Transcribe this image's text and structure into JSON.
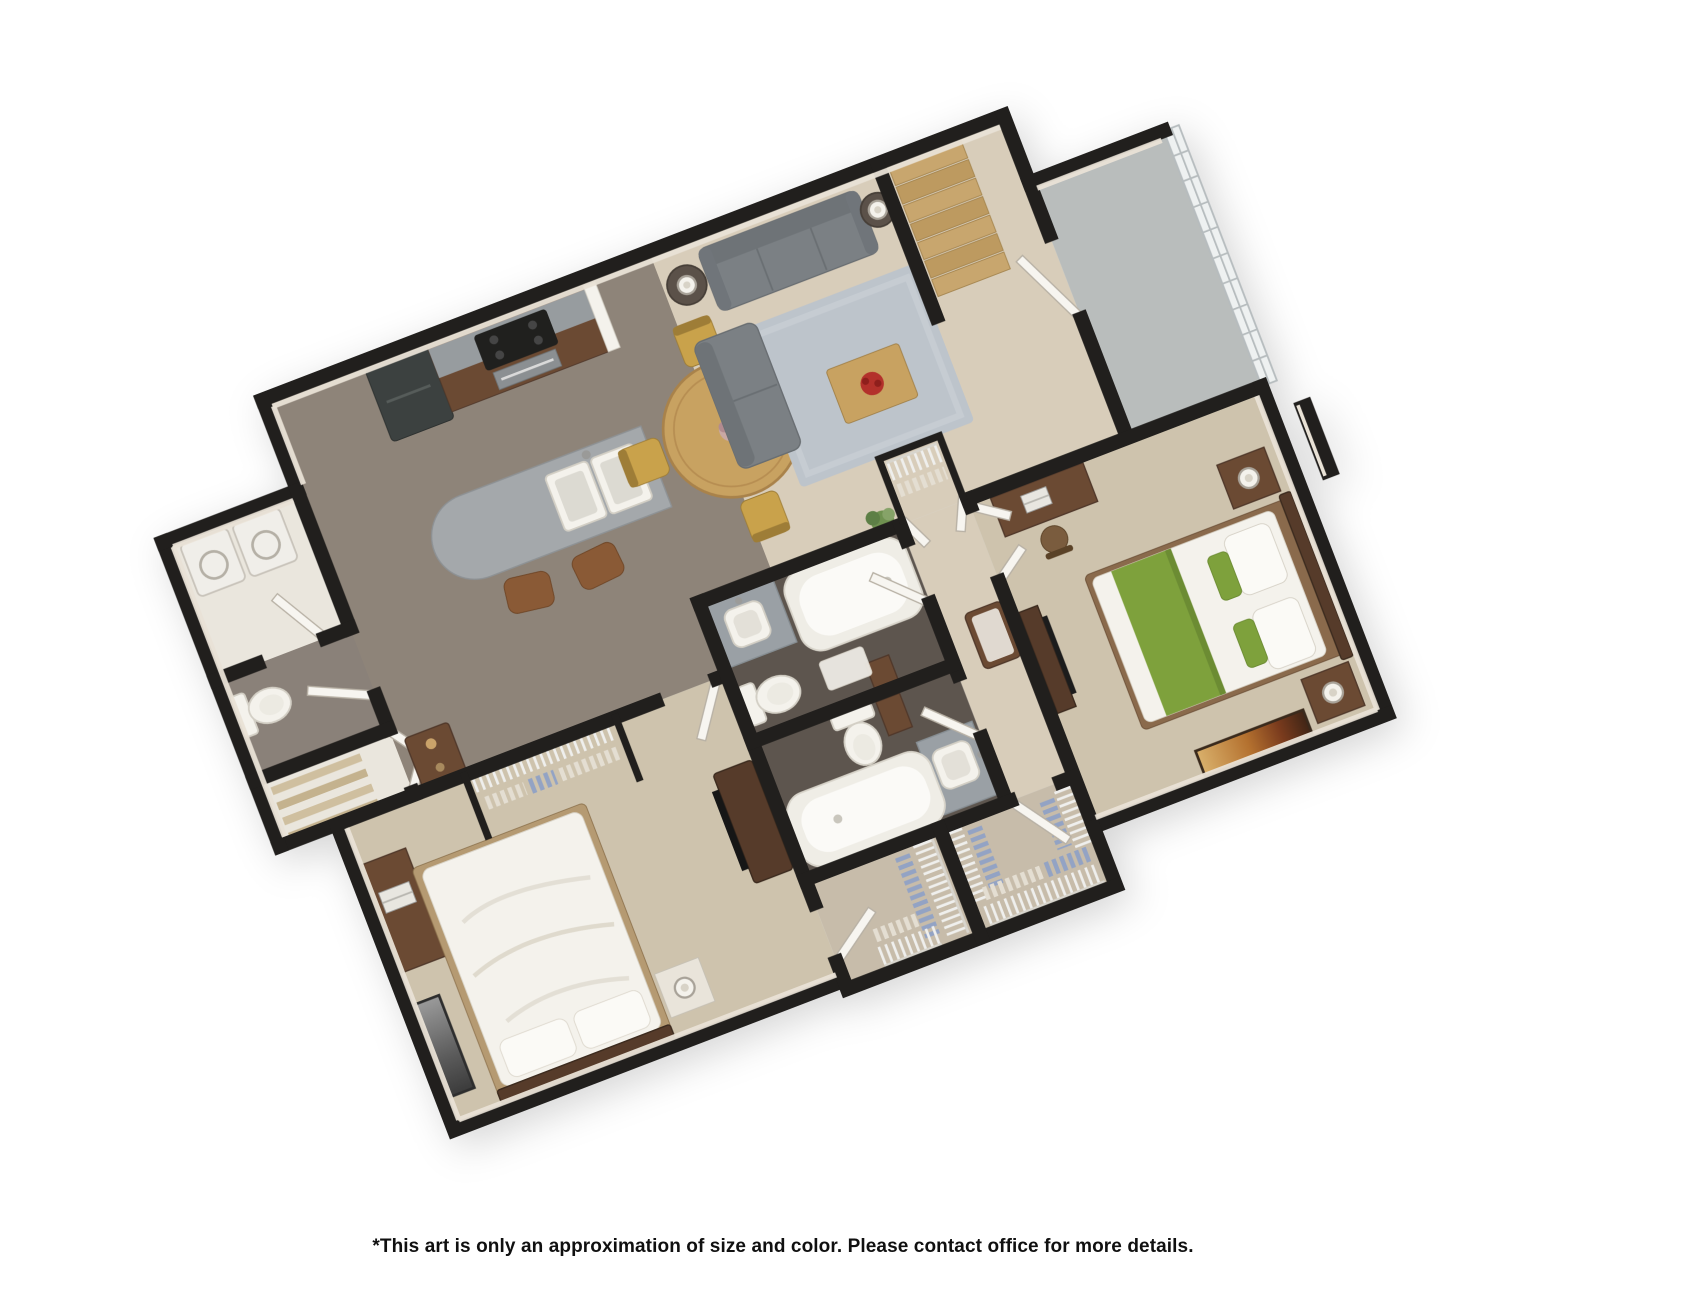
{
  "window": {
    "width": 1704,
    "height": 1294,
    "background": "#ffffff"
  },
  "disclaimer": "*This art is only an approximation of size and color. Please contact office for more details.",
  "floorplan": {
    "type": "3d-rendered-floor-plan",
    "view": "rotated top-down 3D dollhouse render",
    "rotation_deg": -21,
    "layout": "2 bedroom / 2 bathroom apartment with open kitchen-dining-living area, entry stair hall, patio, two walk-in closets, laundry and powder room",
    "colors": {
      "wall": "#211f1d",
      "wall_face": "#e9e2d6",
      "carpet_taupe": "#8e8479",
      "carpet_beige": "#d8cdba",
      "carpet_bedroom": "#cec3ad",
      "tile_bath": "#5d554e",
      "tile_powder": "#8a8179",
      "concrete": "#b9bdbc",
      "closet_floor": "#c7bcaa",
      "floor_white": "#eae6dd",
      "wood_brown": "#6b4a33",
      "wood_dark": "#563b2a",
      "granite": "#9aa0a5",
      "island_granite": "#a4a8ab",
      "appliance_dark": "#3c4140",
      "sofa_gray": "#7b8084",
      "rug_gray": "#bdc4cb",
      "table_wood": "#c8a261",
      "chair_gold": "#c9a24b",
      "steps_wood": "#c5a26b",
      "bed_green": "#7ea13c",
      "linen_white": "#f4f2ec",
      "door_white": "#f7f5f0",
      "shelf_wire": "#efefed",
      "clothes_blue": "#93a3c4",
      "clothes_cream": "#e4ded2",
      "glass": "#eef1f1",
      "glass_mullion": "#b6bcbe",
      "accent_red": "#b3312b",
      "plant_green": "#6f9150",
      "art_gold": "#c08a3e"
    },
    "rooms": [
      {
        "name": "living-room",
        "features": [
          "sofa",
          "loveseat",
          "area-rug",
          "coffee-table",
          "red-floral-centerpiece",
          "end-table",
          "end-table",
          "table-lamp",
          "table-lamp"
        ]
      },
      {
        "name": "dining-area",
        "features": [
          "round-wood-table",
          "dining-chair",
          "dining-chair",
          "dining-chair",
          "dining-chair",
          "centerpiece"
        ]
      },
      {
        "name": "kitchen",
        "features": [
          "refrigerator",
          "range-with-oven",
          "wood-cabinets",
          "granite-counter",
          "island-with-double-sink",
          "bar-stool",
          "bar-stool"
        ]
      },
      {
        "name": "entry-hall",
        "features": [
          "staircase",
          "front-door",
          "coat-closet"
        ]
      },
      {
        "name": "patio",
        "features": [
          "concrete-floor",
          "glass-panel-enclosure",
          "patio-door"
        ]
      },
      {
        "name": "master-bedroom",
        "features": [
          "bed-green-white",
          "headboard",
          "nightstand",
          "nightstand",
          "table-lamp",
          "table-lamp",
          "desk",
          "laptop",
          "desk-chair",
          "media-console",
          "wall-art"
        ]
      },
      {
        "name": "master-closet",
        "features": [
          "wire-shelving",
          "hanging-clothes"
        ]
      },
      {
        "name": "bathroom-1",
        "features": [
          "bathtub",
          "toilet",
          "granite-vanity",
          "sink",
          "bath-mat"
        ]
      },
      {
        "name": "bathroom-2",
        "features": [
          "bathtub",
          "toilet",
          "granite-vanity",
          "sink"
        ]
      },
      {
        "name": "bedroom-2",
        "features": [
          "bed-white",
          "nightstand",
          "table-lamp",
          "desk",
          "laptop",
          "desk-chair",
          "closet-shelf",
          "hanging-clothes",
          "tv-console",
          "tv",
          "leaning-art"
        ]
      },
      {
        "name": "bedroom-2-closet",
        "features": [
          "wire-shelving",
          "hanging-clothes"
        ]
      },
      {
        "name": "laundry-room",
        "features": [
          "washer",
          "dryer"
        ]
      },
      {
        "name": "powder-room",
        "features": [
          "toilet"
        ]
      },
      {
        "name": "linen-closet",
        "features": [
          "shelves"
        ]
      },
      {
        "name": "hallway",
        "features": [
          "bench",
          "plant"
        ]
      }
    ]
  }
}
